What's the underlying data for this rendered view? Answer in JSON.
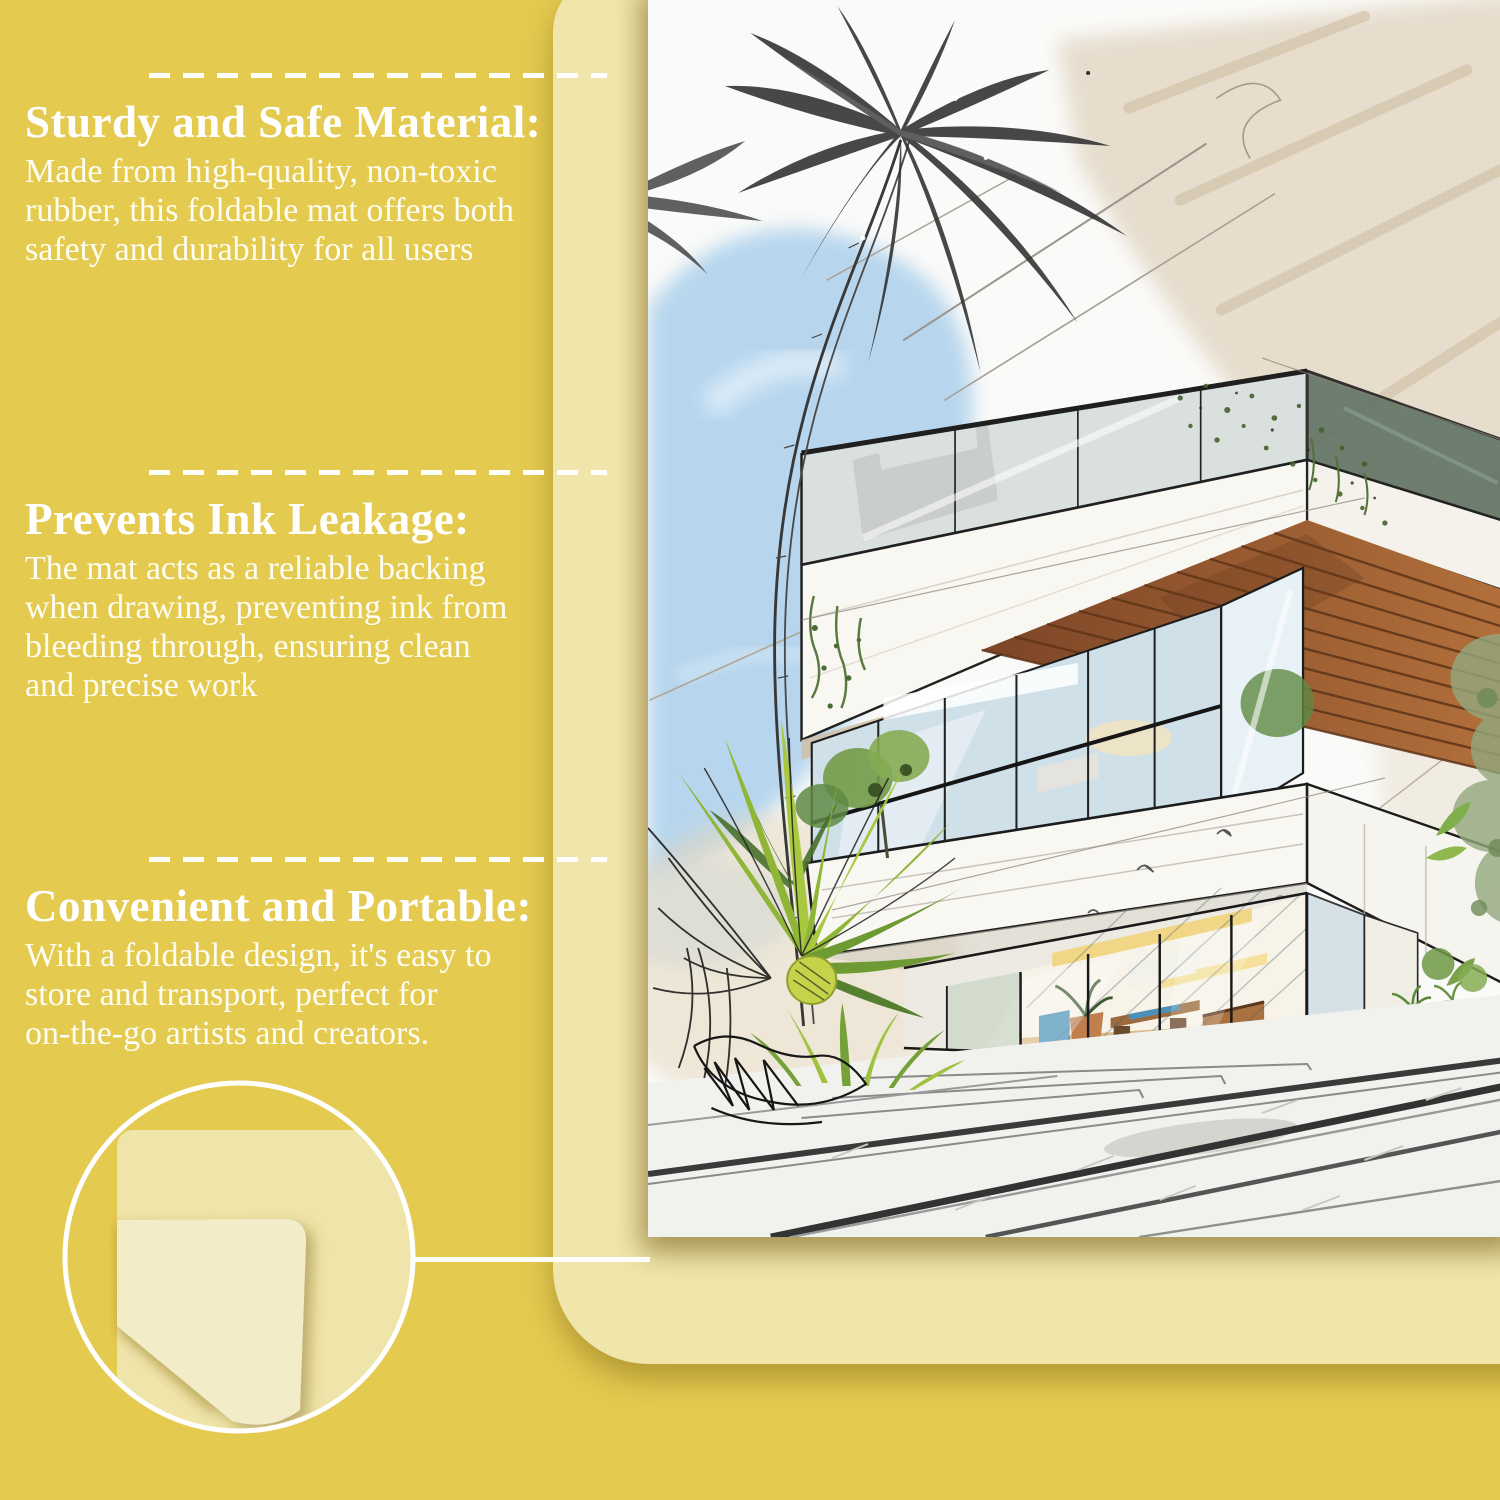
{
  "page": {
    "background_color": "#e5ca50",
    "mat_color": "#f0e6ab",
    "fold_color": "#f3ecc8",
    "paper_color": "#fafaf8",
    "text_color": "#ffffff",
    "divider_color": "#ffffff"
  },
  "features": [
    {
      "title": "Sturdy and Safe Material:",
      "body": "Made from high-quality, non-toxic\nrubber, this foldable mat offers both\nsafety and durability for all users"
    },
    {
      "title": "Prevents Ink Leakage:",
      "body": "The mat acts as a reliable backing\nwhen drawing, preventing ink from\nbleeding through, ensuring clean\nand precise work"
    },
    {
      "title": "Convenient and Portable:",
      "body": "With a foldable design, it's easy to\nstore and transport, perfect for\non-the-go artists and creators."
    }
  ],
  "illustrations": {
    "sketch_name": "modern-house-watercolor-sketch",
    "fold_name": "folded-mat-corner",
    "sketch_colors": {
      "sky": "#a9cfec",
      "sand": "#ddcfb8",
      "wood": "#9a5f33",
      "foliage": "#7aa24b",
      "fruit": "#c6d24a",
      "pencil": "#3a3a3a",
      "interior_light": "#f2d78a"
    }
  }
}
